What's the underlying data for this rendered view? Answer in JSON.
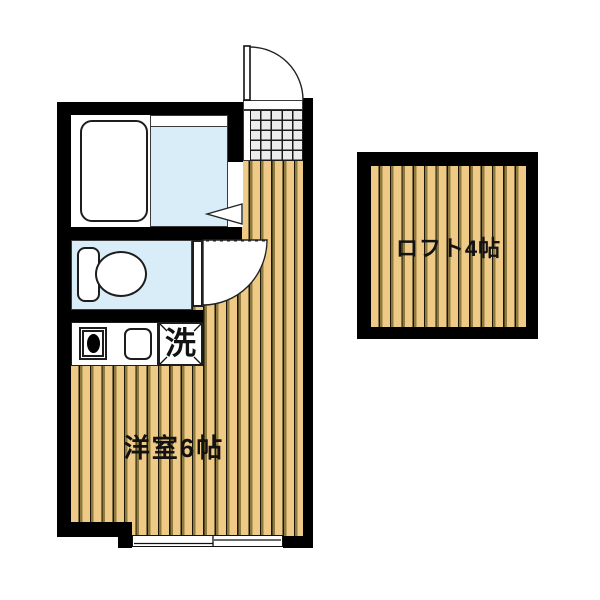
{
  "colors": {
    "wall": "#000000",
    "wood": "#eeca86",
    "stripe1": "#1b1708",
    "stripe2": "#8e7a3e",
    "water": "#d9edf8",
    "tile": "#ececec",
    "ink": "#1c1c1c"
  },
  "labels": {
    "main_room": "洋室6帖",
    "loft": "ロフト4帖",
    "laundry": "洗"
  },
  "fixtures": {
    "entrance_door": "entrance-door-swing-icon",
    "toilet_door": "toilet-door-swing-icon",
    "bathroom_door": "bathroom-door-triangle-icon",
    "bathtub": "bathtub-icon",
    "toilet": "toilet-icon",
    "stove": "stove-burner-icon",
    "sink": "kitchen-sink-icon",
    "window": "sliding-window-icon",
    "entrance_tile": "entrance-tile-floor"
  }
}
